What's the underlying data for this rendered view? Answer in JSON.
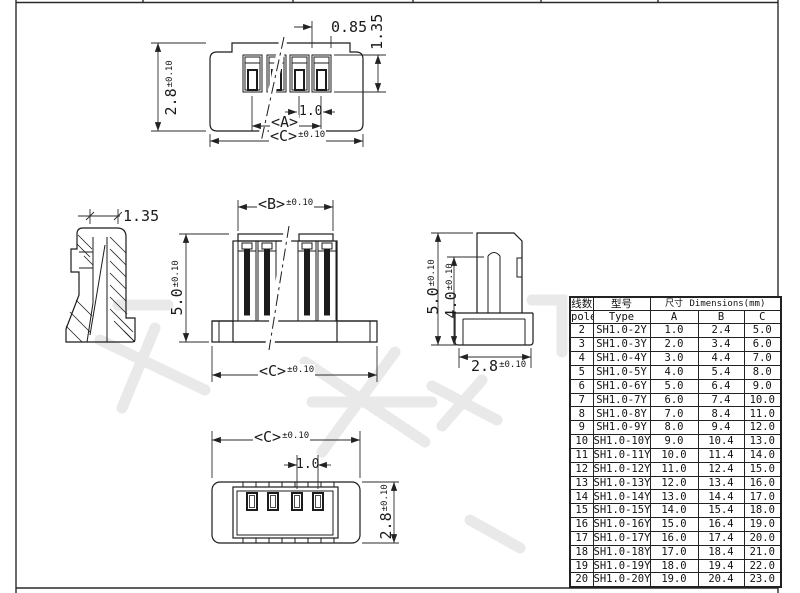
{
  "views": {
    "top_view": {
      "dim_pin_width": "0.85",
      "dim_pin_height": "1.35",
      "dim_depth": "2.8",
      "dim_depth_tol": "±0.10",
      "dim_pitch": "1.0",
      "dim_a": "<A>",
      "dim_c": "<C>",
      "dim_c_tol": "±0.10"
    },
    "left_section_view": {
      "dim_width": "1.35"
    },
    "front_view": {
      "dim_b": "<B>",
      "dim_b_tol": "±0.10",
      "dim_height": "5.0",
      "dim_height_tol": "±0.10",
      "dim_c": "<C>",
      "dim_c_tol": "±0.10"
    },
    "right_side_view": {
      "dim_height": "5.0",
      "dim_height_tol": "±0.10",
      "dim_inner_height": "4.0",
      "dim_inner_height_tol": "±0.10",
      "dim_depth": "2.8",
      "dim_depth_tol": "±0.10"
    },
    "bottom_view": {
      "dim_c": "<C>",
      "dim_c_tol": "±0.10",
      "dim_pitch": "1.0",
      "dim_depth": "2.8",
      "dim_depth_tol": "±0.10"
    }
  },
  "table": {
    "header": {
      "poles_zh": "线数",
      "poles_en": "poles",
      "type_zh": "型号",
      "type_en": "Type",
      "dims_zh": "尺寸",
      "dims_en": "Dimensions(mm)",
      "col_a": "A",
      "col_b": "B",
      "col_c": "C"
    },
    "rows": [
      {
        "poles": "2",
        "type": "SH1.0-2Y",
        "a": "1.0",
        "b": "2.4",
        "c": "5.0"
      },
      {
        "poles": "3",
        "type": "SH1.0-3Y",
        "a": "2.0",
        "b": "3.4",
        "c": "6.0"
      },
      {
        "poles": "4",
        "type": "SH1.0-4Y",
        "a": "3.0",
        "b": "4.4",
        "c": "7.0"
      },
      {
        "poles": "5",
        "type": "SH1.0-5Y",
        "a": "4.0",
        "b": "5.4",
        "c": "8.0"
      },
      {
        "poles": "6",
        "type": "SH1.0-6Y",
        "a": "5.0",
        "b": "6.4",
        "c": "9.0"
      },
      {
        "poles": "7",
        "type": "SH1.0-7Y",
        "a": "6.0",
        "b": "7.4",
        "c": "10.0"
      },
      {
        "poles": "8",
        "type": "SH1.0-8Y",
        "a": "7.0",
        "b": "8.4",
        "c": "11.0"
      },
      {
        "poles": "9",
        "type": "SH1.0-9Y",
        "a": "8.0",
        "b": "9.4",
        "c": "12.0"
      },
      {
        "poles": "10",
        "type": "SH1.0-10Y",
        "a": "9.0",
        "b": "10.4",
        "c": "13.0"
      },
      {
        "poles": "11",
        "type": "SH1.0-11Y",
        "a": "10.0",
        "b": "11.4",
        "c": "14.0"
      },
      {
        "poles": "12",
        "type": "SH1.0-12Y",
        "a": "11.0",
        "b": "12.4",
        "c": "15.0"
      },
      {
        "poles": "13",
        "type": "SH1.0-13Y",
        "a": "12.0",
        "b": "13.4",
        "c": "16.0"
      },
      {
        "poles": "14",
        "type": "SH1.0-14Y",
        "a": "13.0",
        "b": "14.4",
        "c": "17.0"
      },
      {
        "poles": "15",
        "type": "SH1.0-15Y",
        "a": "14.0",
        "b": "15.4",
        "c": "18.0"
      },
      {
        "poles": "16",
        "type": "SH1.0-16Y",
        "a": "15.0",
        "b": "16.4",
        "c": "19.0"
      },
      {
        "poles": "17",
        "type": "SH1.0-17Y",
        "a": "16.0",
        "b": "17.4",
        "c": "20.0"
      },
      {
        "poles": "18",
        "type": "SH1.0-18Y",
        "a": "17.0",
        "b": "18.4",
        "c": "21.0"
      },
      {
        "poles": "19",
        "type": "SH1.0-19Y",
        "a": "18.0",
        "b": "19.4",
        "c": "22.0"
      },
      {
        "poles": "20",
        "type": "SH1.0-20Y",
        "a": "19.0",
        "b": "20.4",
        "c": "23.0"
      }
    ]
  }
}
